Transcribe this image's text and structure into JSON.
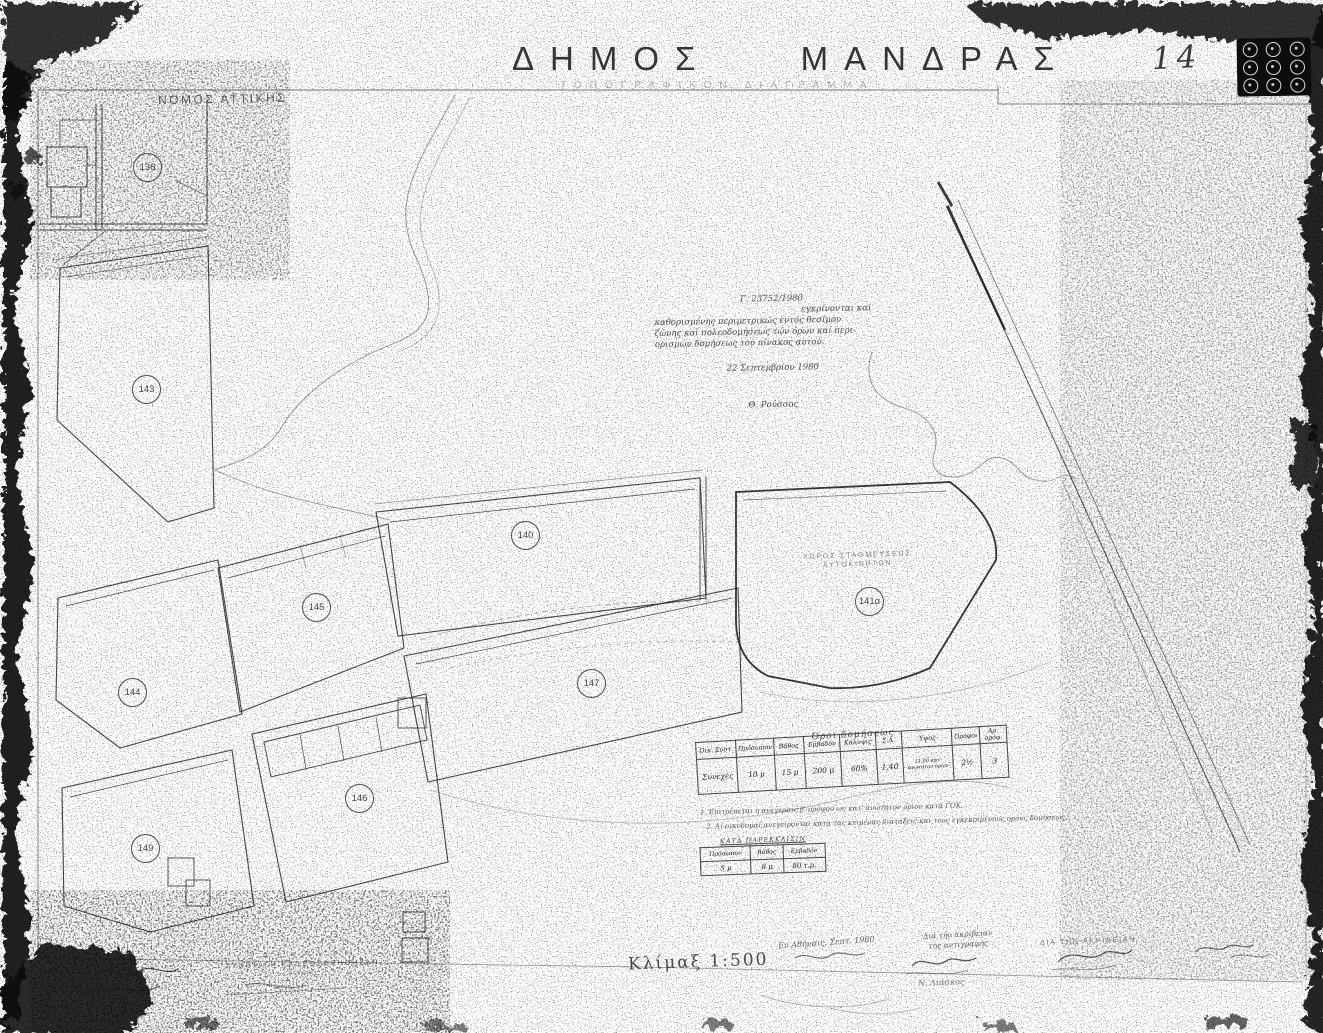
{
  "header": {
    "region": "ΝΟΜΟΣ ΑΤΤΙΚΗΣ",
    "title": "ΔΗΜΟΣ ΜΑΝΔΡΑΣ",
    "subtitle": "ΤΟΠΟΓΡΑΦΙΚΟΝ ΔΙΑΓΡΑΜΜΑ",
    "sheet_number": "14"
  },
  "approval_note": {
    "ref": "Γ. 23752/1980",
    "line1": "εγκρίνονται καί",
    "line2": "καθορισμένης περιμετρικώς εντός θεσίμου",
    "line3": "ζώνης καί πολεοδομήσεως τών όρων καί περι-",
    "line4": "ορισμών δομήσεως τού πίνακος αυτού.",
    "date": "22 Σεπτεμβρίου 1980",
    "signer": "Θ. Ρούσσος"
  },
  "map": {
    "plots": [
      {
        "label": "136"
      },
      {
        "label": "143"
      },
      {
        "label": "140"
      },
      {
        "label": "145"
      },
      {
        "label": "144"
      },
      {
        "label": "147"
      },
      {
        "label": "141α"
      },
      {
        "label": "146"
      },
      {
        "label": "149"
      }
    ],
    "area_label_line1": "ΧΩΡΟΣ ΣΤΑΘΜΕΥΣΕΩΣ",
    "area_label_line2": "ΑΥΤΟΚΙΝΗΤΩΝ"
  },
  "terms_table": {
    "title": "Όροι δομήσεως",
    "headers": [
      "Οικ. Σύστ.",
      "Πρόσωπον",
      "Βάθος",
      "Εμβαδόν",
      "Κάλυψις",
      "Σ.Δ.",
      "Ύψος",
      "Όροφοι",
      "Αρ. ορόφ."
    ],
    "row": [
      "Συνεχές",
      "10 μ",
      "15 μ",
      "200 μ",
      "60%",
      "1,40",
      "11,00 κατ' ανώτατον όριον",
      "2½",
      "3"
    ]
  },
  "notes": [
    "1. Επιτρέπεται η ανέγερσις β' ορόφου ως κατ' ανώτατον όριον κατά ΓΟΚ.",
    "2. Αι οικοδομαί ανεγείρονται κατά τας κειμένας διατάξεις και τους εγκεκριμένους όρους δομήσεως."
  ],
  "exception_table": {
    "title": "ΚΑΤΑ ΠΑΡΕΚΚΛΙΣΙΝ",
    "headers": [
      "Πρόσωπον",
      "Βάθος",
      "Εμβαδόν"
    ],
    "row": [
      "5 μ",
      "8 μ",
      "80 τ.μ."
    ]
  },
  "scale": {
    "label": "Κλίμαξ 1:500"
  },
  "stamp": {
    "line1": "Ε Θ Ε Ω Ρ Η Θ Η",
    "line2": "ΣΥΝΕΤΑΓΗ ΚΑΙ ΕΘΕΩΡΗΘΗΣΑΝ",
    "line3": "ΑΘΗΝΑΙ"
  },
  "signatures": {
    "left_note": "Εν Αθήναις, Σεπτ. 1980",
    "mid_line1": "Διά τήν ακρίβειαν",
    "mid_line2": "τής αντιγραφής",
    "mid_name": "Ν. Λιάσκος",
    "right_caption": "ΔΙΑ ΤΗΝ ΑΚΡΙΒΕΙΑΝ"
  }
}
